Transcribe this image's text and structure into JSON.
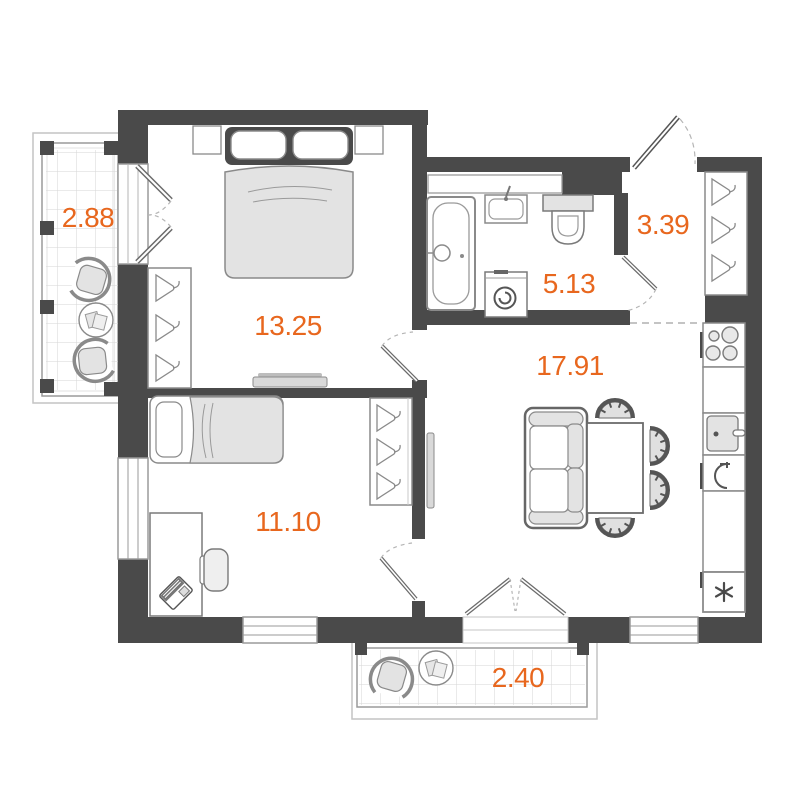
{
  "plan": {
    "title": "apartment-floor-plan",
    "accent_color": "#E8671E",
    "wall_color": "#4A4A4A",
    "furniture_fill": "#E3E3E3",
    "rooms": [
      {
        "name": "balcony-left",
        "area": "2.88"
      },
      {
        "name": "bedroom",
        "area": "13.25"
      },
      {
        "name": "bathroom",
        "area": "5.13"
      },
      {
        "name": "hallway",
        "area": "3.39"
      },
      {
        "name": "living-kitchen",
        "area": "17.91"
      },
      {
        "name": "room-second",
        "area": "11.10"
      },
      {
        "name": "balcony-bottom",
        "area": "2.40"
      }
    ]
  }
}
